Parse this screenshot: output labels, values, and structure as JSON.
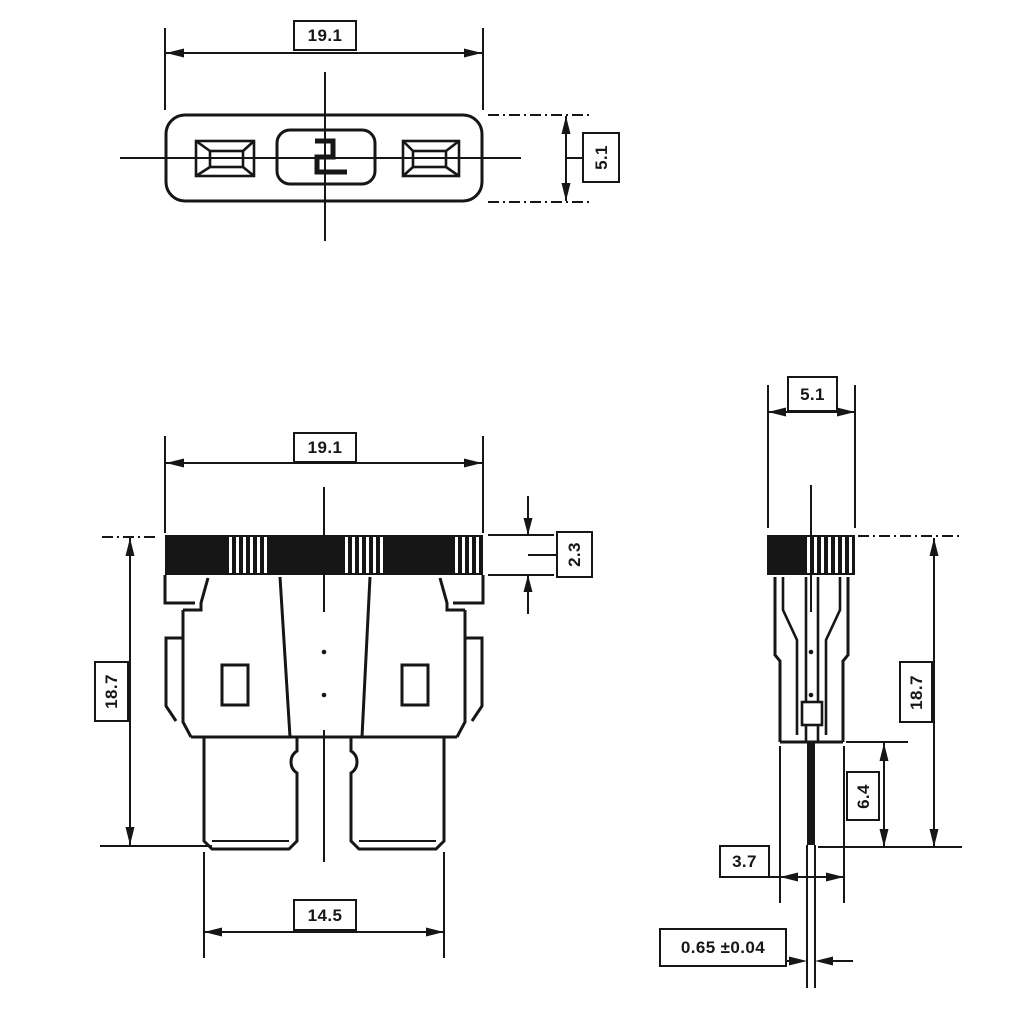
{
  "drawing": {
    "type": "technical-dimension-drawing",
    "marking": "2",
    "colors": {
      "line": "#161616",
      "background": "#ffffff"
    },
    "dimensions": {
      "top_width": "19.1",
      "top_depth": "5.1",
      "front_width": "19.1",
      "band_height": "2.3",
      "front_height": "18.7",
      "blade_span": "14.5",
      "side_width": "5.1",
      "side_height": "18.7",
      "blade_length": "6.4",
      "bottom_width": "3.7",
      "blade_thickness": "0.65 ±0.04"
    }
  }
}
